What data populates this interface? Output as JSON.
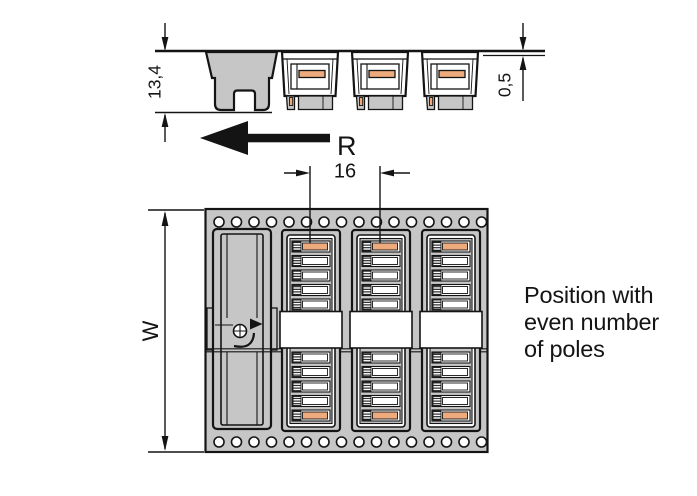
{
  "colors": {
    "tape_gray": "#c6c6c6",
    "contact_orange": "#edaa7d",
    "line_black": "#141414",
    "background": "#ffffff"
  },
  "side_view": {
    "dim_height_label": "13,4",
    "dim_thickness_label": "0,5",
    "direction_label": "R"
  },
  "top_view": {
    "dim_pitch_label": "16",
    "dim_width_label": "W"
  },
  "caption": {
    "line1": "Position with",
    "line2": "even number",
    "line3": "of poles"
  }
}
